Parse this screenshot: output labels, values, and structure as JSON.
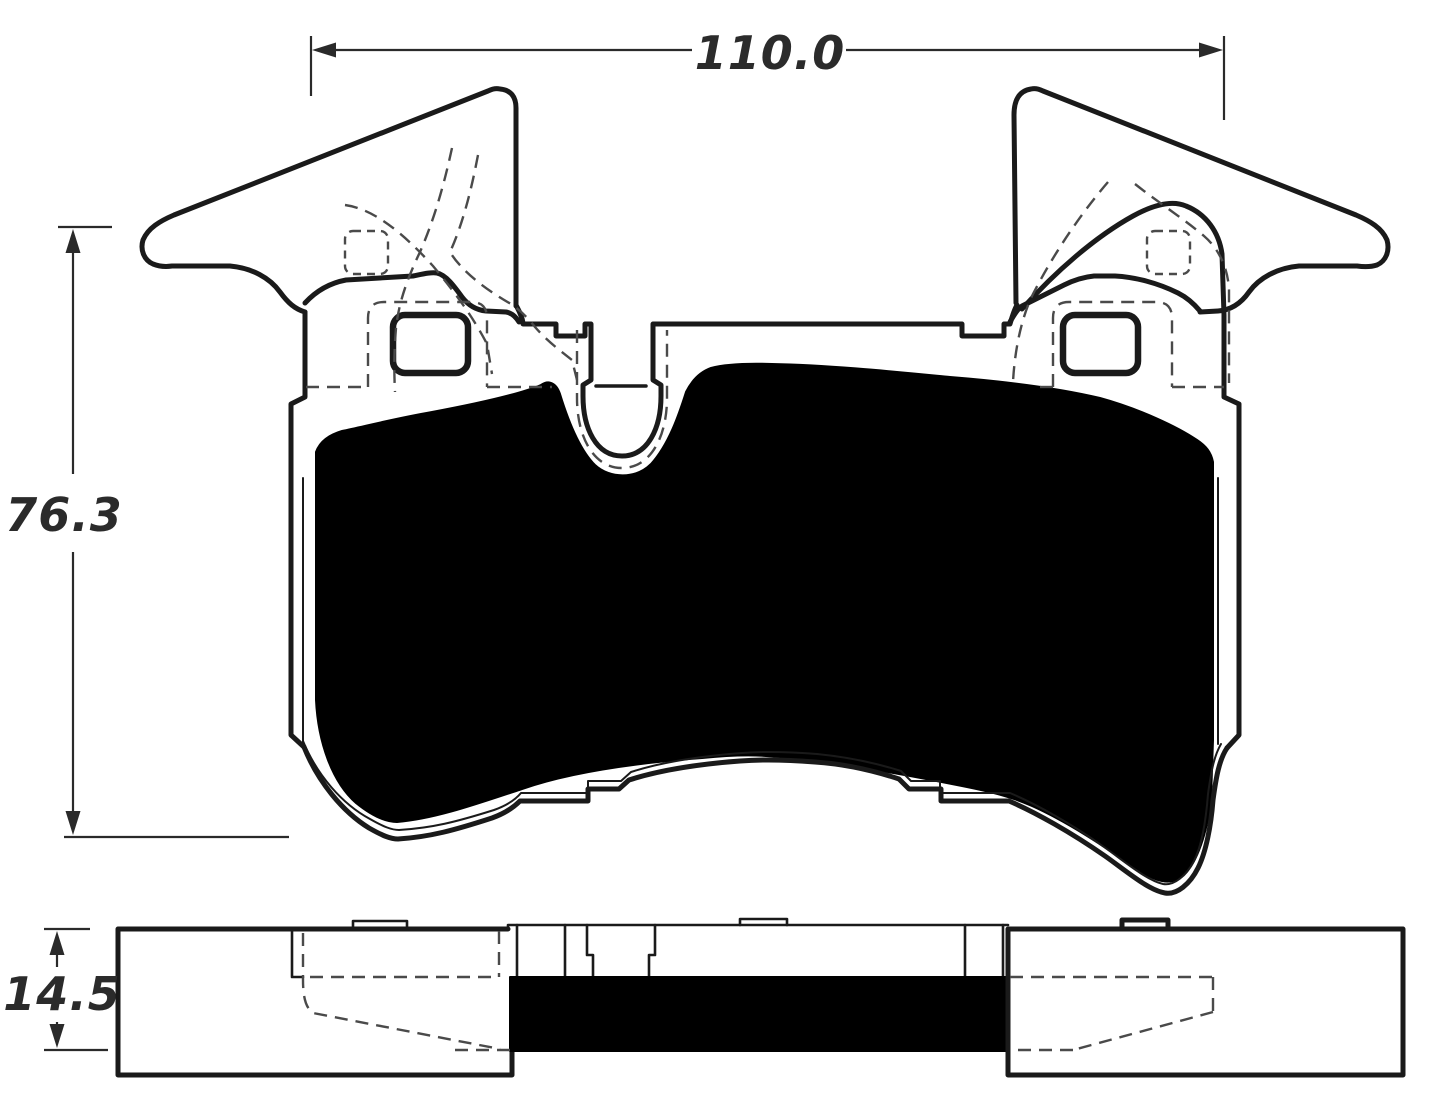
{
  "drawing_type": "brake-pad-technical-drawing",
  "colors": {
    "line": "#1a1a1a",
    "hidden_line": "#4a4a4a",
    "friction_fill": "#000000",
    "background": "#ffffff"
  },
  "front_view": {
    "dimension_width": {
      "label": "110.0"
    },
    "dimension_height": {
      "label": "76.3"
    }
  },
  "side_view": {
    "dimension_thickness": {
      "label": "14.5"
    }
  }
}
